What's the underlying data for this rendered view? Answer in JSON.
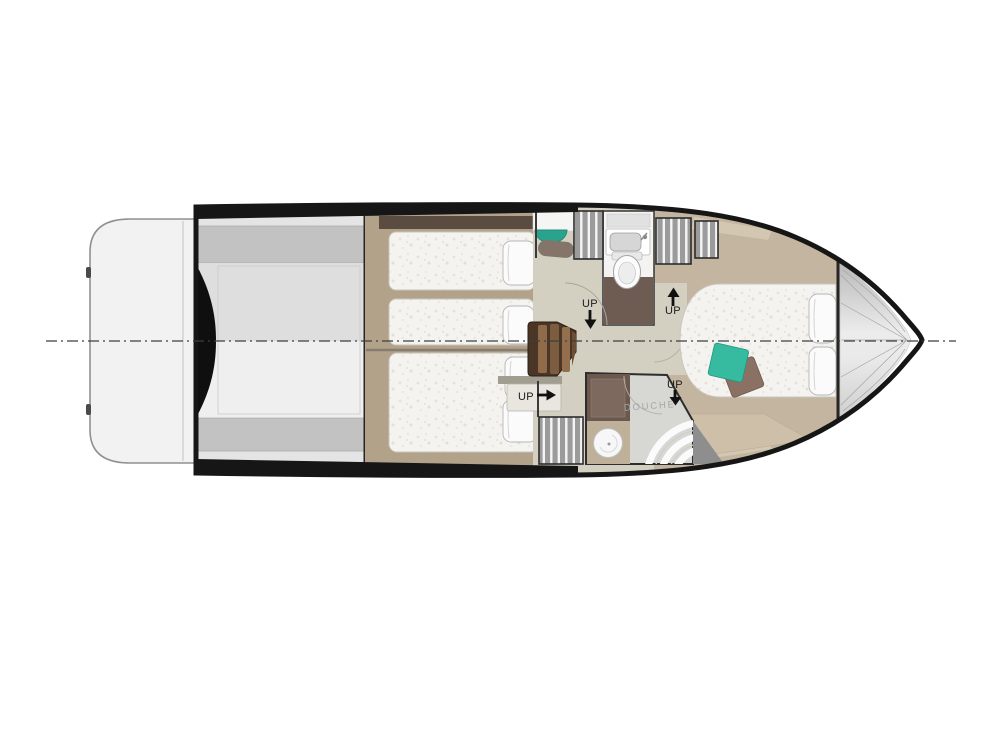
{
  "figure": {
    "type": "yacht-lower-deck-floor-plan",
    "labels": {
      "up_companionway": "UP",
      "up_master_entry": "UP",
      "up_guest_cabin": "UP",
      "up_shower": "UP",
      "shower_room": "DOUCHE"
    },
    "colors": {
      "hull": "#161616",
      "centerline": "#3f3f3f",
      "platform": "#f2f2f2",
      "garage_band": "#c2c2c2",
      "wood_floor": "#b3a28a",
      "trim_dark": "#5a4c41",
      "bed": "#f4f3ef",
      "pillow": "#fbfbfb",
      "lobby_floor": "#d3cfc1",
      "locker_grey": "#9b9b9b",
      "bathroom_floor_dark": "#6e5c52",
      "stair_base": "#4a3526",
      "stair_wood": "#8f6b4a",
      "master_floor": "#c3b5a0",
      "teal_cushion": "#37bba0",
      "brown_cushion": "#8a7163",
      "shower_floor": "#d7d7d4",
      "bow_grey": "#d9d9d9",
      "wedge_grey": "#8e8e8e"
    }
  }
}
